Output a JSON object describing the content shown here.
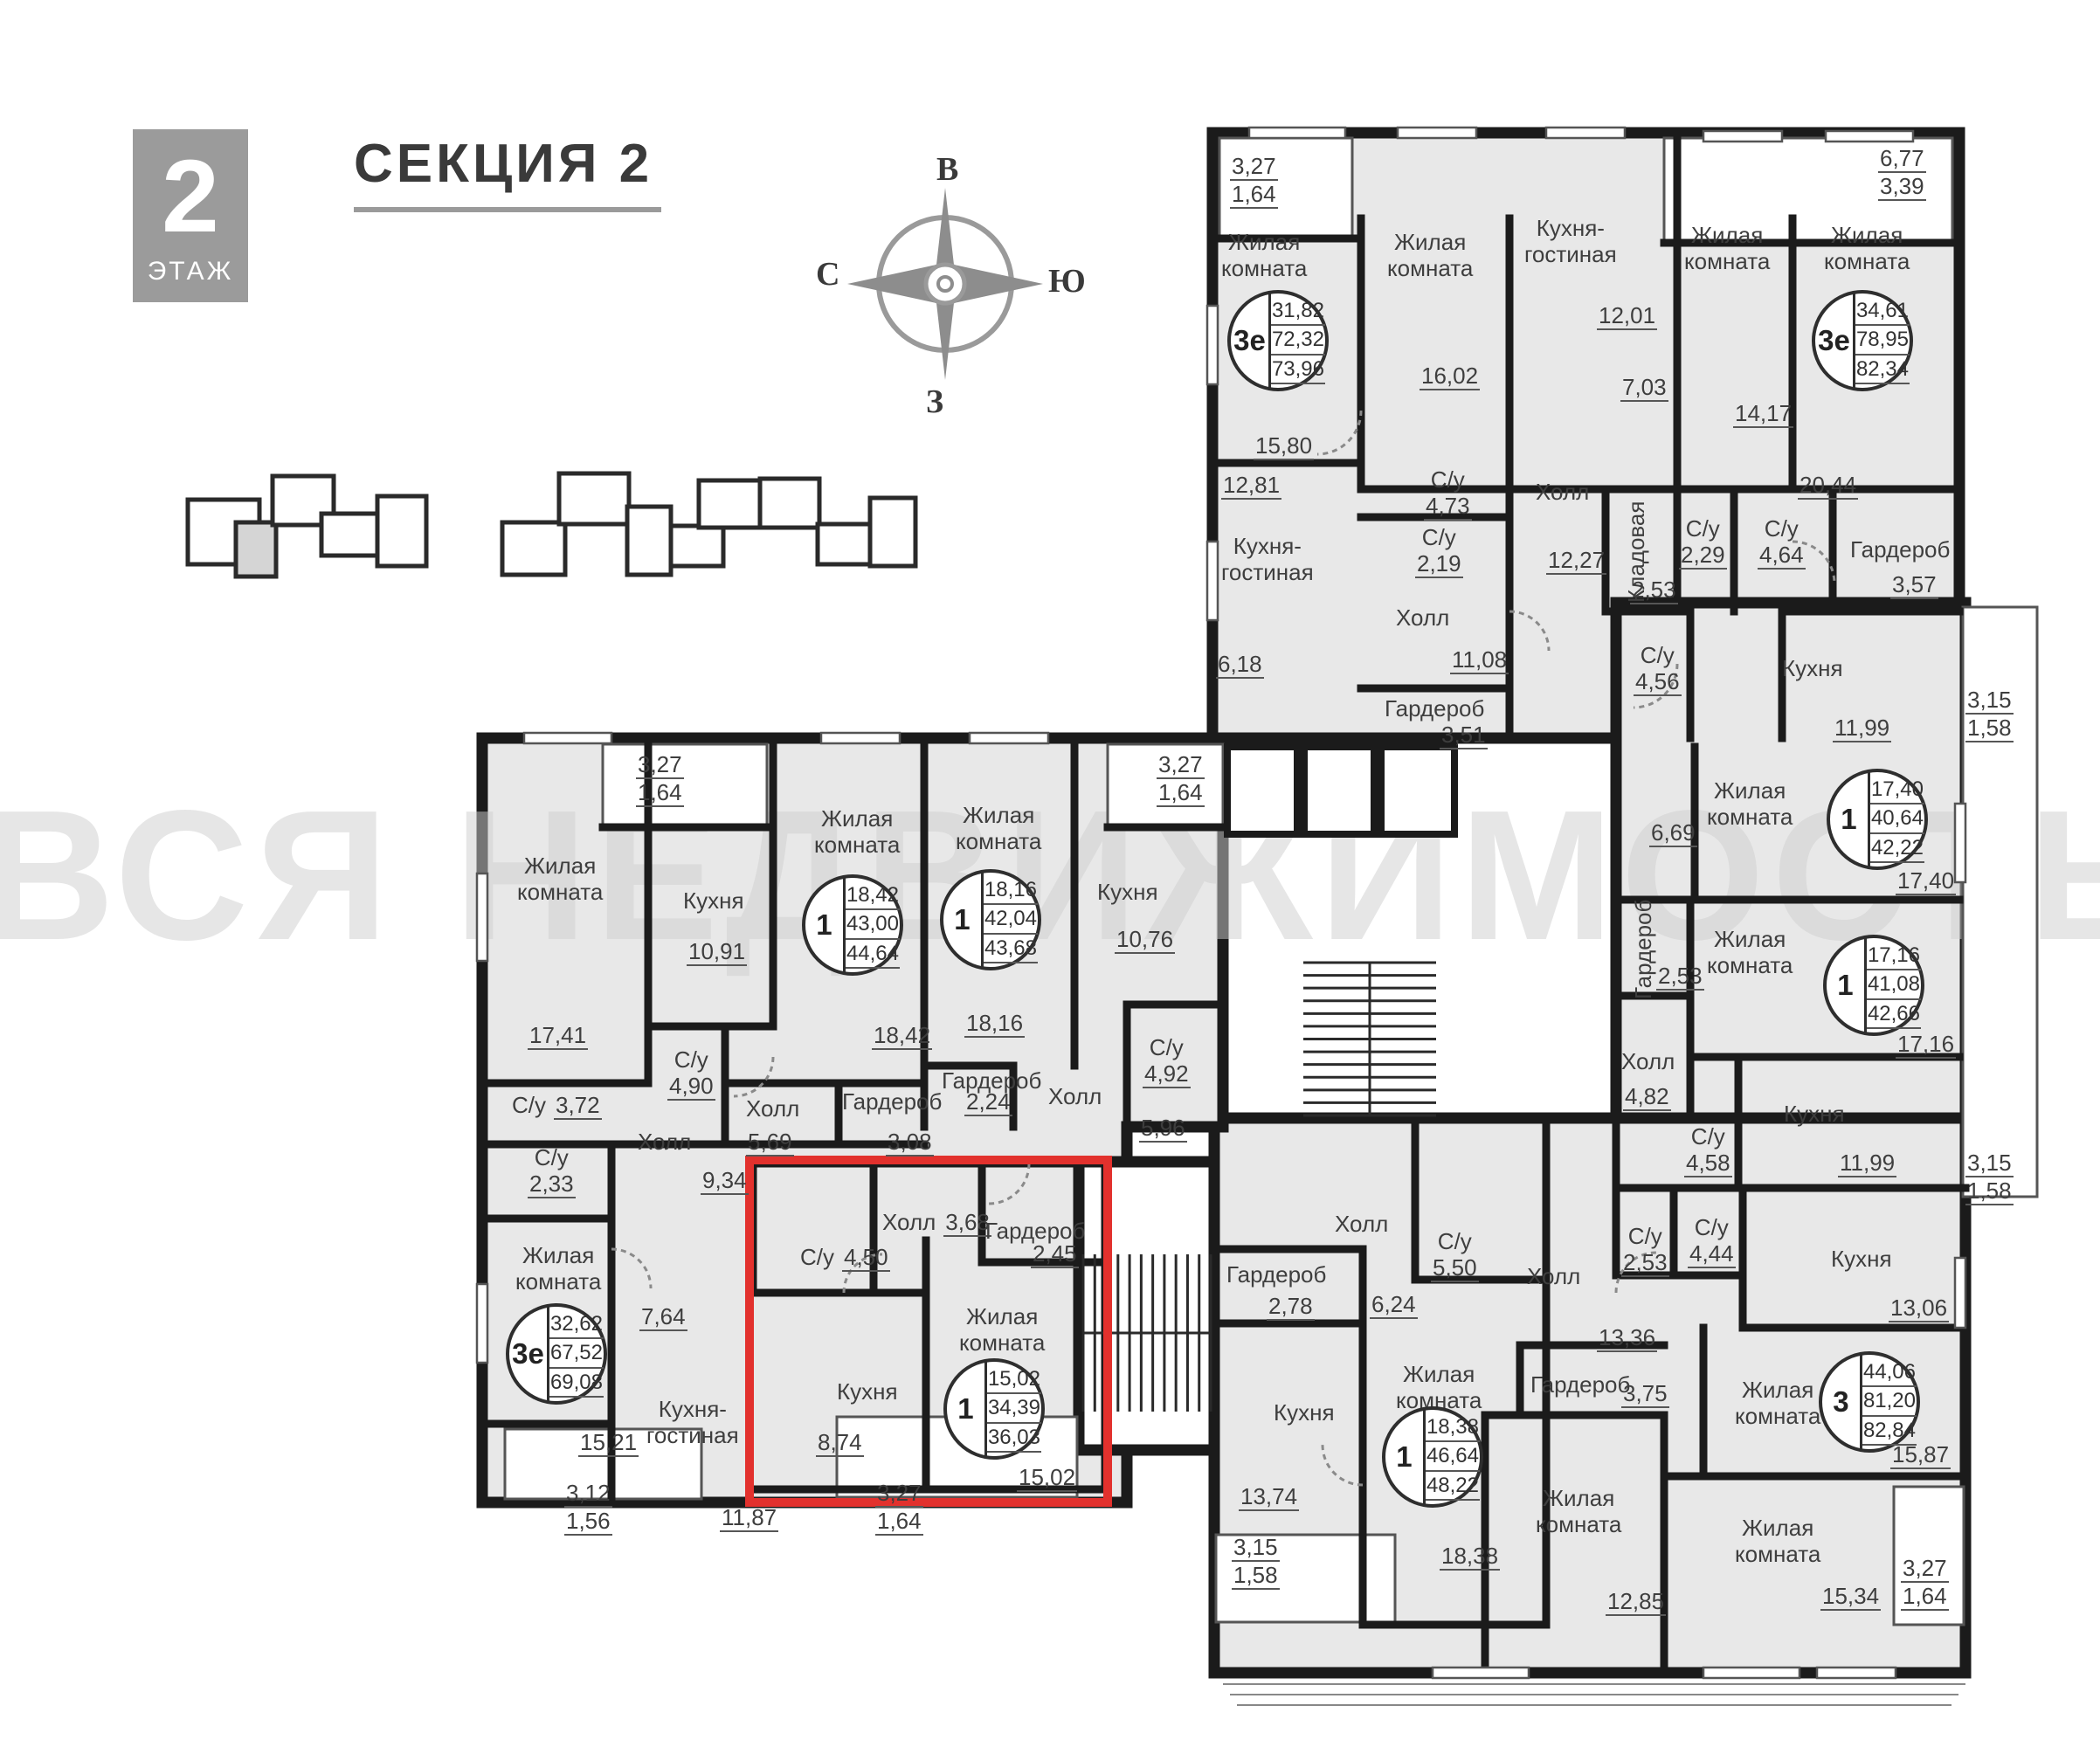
{
  "header": {
    "floor_number": "2",
    "floor_word": "ЭТАЖ",
    "section_title": "СЕКЦИЯ 2"
  },
  "compass": {
    "top": "В",
    "right": "Ю",
    "bottom": "З",
    "left": "С"
  },
  "watermark": "ВСЯ НЕДВИЖИМОСТЬ",
  "colors": {
    "highlight_red": "#e2312d",
    "wall": "#1b1b1b",
    "room_fill": "#e8e8e8"
  },
  "units": [
    {
      "type": "3е",
      "living": "31,82",
      "area": "72,32",
      "total": "73,96"
    },
    {
      "type": "3е",
      "living": "34,61",
      "area": "78,95",
      "total": "82,34"
    },
    {
      "type": "1",
      "living": "18,42",
      "area": "43,00",
      "total": "44,64"
    },
    {
      "type": "1",
      "living": "18,16",
      "area": "42,04",
      "total": "43,68"
    },
    {
      "type": "3е",
      "living": "32,62",
      "area": "67,52",
      "total": "69,08"
    },
    {
      "type": "1",
      "living": "15,02",
      "area": "34,39",
      "total": "36,03"
    },
    {
      "type": "1",
      "living": "18,38",
      "area": "46,64",
      "total": "48,22"
    },
    {
      "type": "1",
      "living": "17,40",
      "area": "40,64",
      "total": "42,22"
    },
    {
      "type": "1",
      "living": "17,16",
      "area": "41,08",
      "total": "42,66"
    },
    {
      "type": "3",
      "living": "44,06",
      "area": "81,20",
      "total": "82,84"
    }
  ],
  "labels": [
    {
      "n": "3,27",
      "n2": "1,64"
    },
    {
      "t": "Жилая\nкомната"
    },
    {
      "n": "15,80"
    },
    {
      "t": "Жилая\nкомната"
    },
    {
      "n": "16,02"
    },
    {
      "n": "12,81"
    },
    {
      "t": "Кухня-\nгостиная"
    },
    {
      "n": "6,18"
    },
    {
      "t": "С/у",
      "n": "4,73"
    },
    {
      "t": "С/у",
      "n": "2,19"
    },
    {
      "t": "Холл"
    },
    {
      "n": "11,08"
    },
    {
      "t": "Гардероб"
    },
    {
      "n": "3,51"
    },
    {
      "t": "Кухня-\nгостиная"
    },
    {
      "n": "12,01"
    },
    {
      "n": "7,03"
    },
    {
      "t": "Холл"
    },
    {
      "n": "12,27"
    },
    {
      "t": "Кладовая"
    },
    {
      "n": "2,53"
    },
    {
      "t": "Жилая\nкомната"
    },
    {
      "n": "14,17"
    },
    {
      "t": "Жилая\nкомната"
    },
    {
      "n": "20,44"
    },
    {
      "n": "6,77",
      "n2": "3,39"
    },
    {
      "t": "С/у",
      "n": "2,29"
    },
    {
      "t": "С/у",
      "n": "4,64"
    },
    {
      "t": "Гардероб"
    },
    {
      "n": "3,57"
    },
    {
      "t": "С/у",
      "n": "4,56"
    },
    {
      "t": "Кухня"
    },
    {
      "n": "11,99"
    },
    {
      "n": "3,15",
      "n2": "1,58"
    },
    {
      "t": "Жилая\nкомната"
    },
    {
      "n": "17,40"
    },
    {
      "n": "6,69"
    },
    {
      "t": "Гардероб"
    },
    {
      "n": "2,53"
    },
    {
      "t": "Жилая\nкомната"
    },
    {
      "n": "17,16"
    },
    {
      "t": "Холл"
    },
    {
      "n": "4,82"
    },
    {
      "t": "С/у",
      "n": "4,58"
    },
    {
      "t": "Кухня"
    },
    {
      "n": "11,99"
    },
    {
      "n": "3,15",
      "n2": "1,58"
    },
    {
      "t": "С/у",
      "n": "2,53"
    },
    {
      "t": "С/у",
      "n": "4,44"
    },
    {
      "t": "Кухня"
    },
    {
      "n": "13,06"
    },
    {
      "t": "Холл"
    },
    {
      "n": "13,36"
    },
    {
      "t": "Гардероб"
    },
    {
      "n": "3,75"
    },
    {
      "t": "Жилая\nкомната"
    },
    {
      "n": "15,87"
    },
    {
      "t": "Жилая\nкомната"
    },
    {
      "n": "15,34"
    },
    {
      "n": "3,27",
      "n2": "1,64"
    },
    {
      "t": "Жилая\nкомната"
    },
    {
      "n": "12,85"
    },
    {
      "t": "Гардероб"
    },
    {
      "n": "2,78"
    },
    {
      "t": "Холл"
    },
    {
      "n": "6,24"
    },
    {
      "t": "С/у",
      "n": "5,50"
    },
    {
      "t": "Кухня"
    },
    {
      "n": "13,74"
    },
    {
      "n": "3,15",
      "n2": "1,58"
    },
    {
      "t": "Жилая\nкомната"
    },
    {
      "n": "18,38"
    },
    {
      "t": "Жилая\nкомната"
    },
    {
      "n": "17,41"
    },
    {
      "n": "3,27",
      "n2": "1,64"
    },
    {
      "t": "Кухня"
    },
    {
      "n": "10,91"
    },
    {
      "t": "Жилая\nкомната"
    },
    {
      "n": "18,42"
    },
    {
      "t": "Жилая\nкомната"
    },
    {
      "n": "18,16"
    },
    {
      "n": "3,27",
      "n2": "1,64"
    },
    {
      "t": "Кухня"
    },
    {
      "n": "10,76"
    },
    {
      "t": "С/у",
      "n": "3,72"
    },
    {
      "t": "С/у",
      "n": "4,90"
    },
    {
      "t": "Холл"
    },
    {
      "n": "5,69"
    },
    {
      "t": "Гардероб"
    },
    {
      "n": "3,08"
    },
    {
      "t": "Гардероб"
    },
    {
      "n": "2,24"
    },
    {
      "t": "Холл"
    },
    {
      "n": "5,96"
    },
    {
      "t": "С/у",
      "n": "4,92"
    },
    {
      "t": "С/у",
      "n": "2,33"
    },
    {
      "t": "Холл"
    },
    {
      "n": "9,34"
    },
    {
      "t": "Жилая\nкомната"
    },
    {
      "n": "15,21"
    },
    {
      "n": "7,64"
    },
    {
      "t": "Кухня-\nгостиная"
    },
    {
      "n": "11,87"
    },
    {
      "n": "3,12",
      "n2": "1,56"
    },
    {
      "t": "Холл",
      "n": "3,68"
    },
    {
      "t": "С/у",
      "n": "4,50"
    },
    {
      "t": "Гардероб"
    },
    {
      "n": "2,45"
    },
    {
      "t": "Жилая\nкомната"
    },
    {
      "n": "15,02"
    },
    {
      "t": "Кухня"
    },
    {
      "n": "8,74"
    },
    {
      "n": "3,27",
      "n2": "1,64"
    }
  ]
}
